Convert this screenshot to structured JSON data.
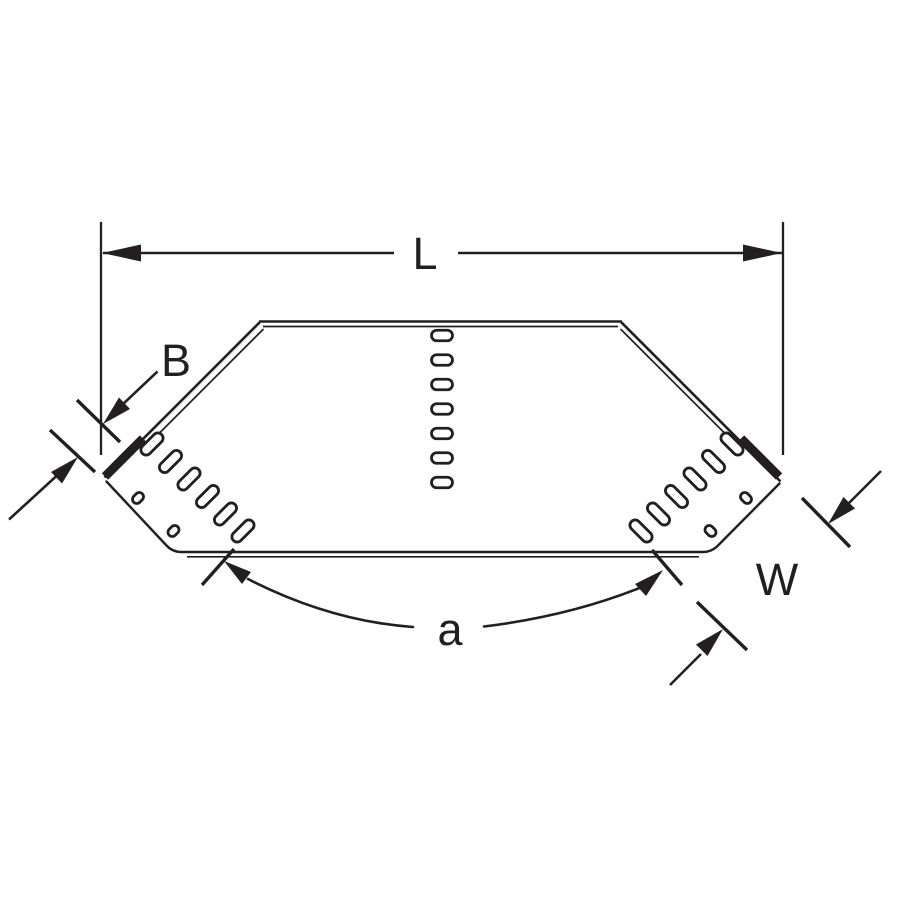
{
  "diagram": {
    "kind": "cable-tray-fitting-line-drawing",
    "dimension_labels": {
      "overall_length": "L",
      "side_rail": "B",
      "width": "W",
      "angle": "a"
    },
    "colors": {
      "ink": "#231f20",
      "background": "#ffffff"
    },
    "perforations": {
      "center_slot_count": 7,
      "left_wall_slot_count": 6,
      "right_wall_slot_count": 6,
      "left_wall_small_hole_count": 2,
      "right_wall_small_hole_count": 2
    }
  }
}
